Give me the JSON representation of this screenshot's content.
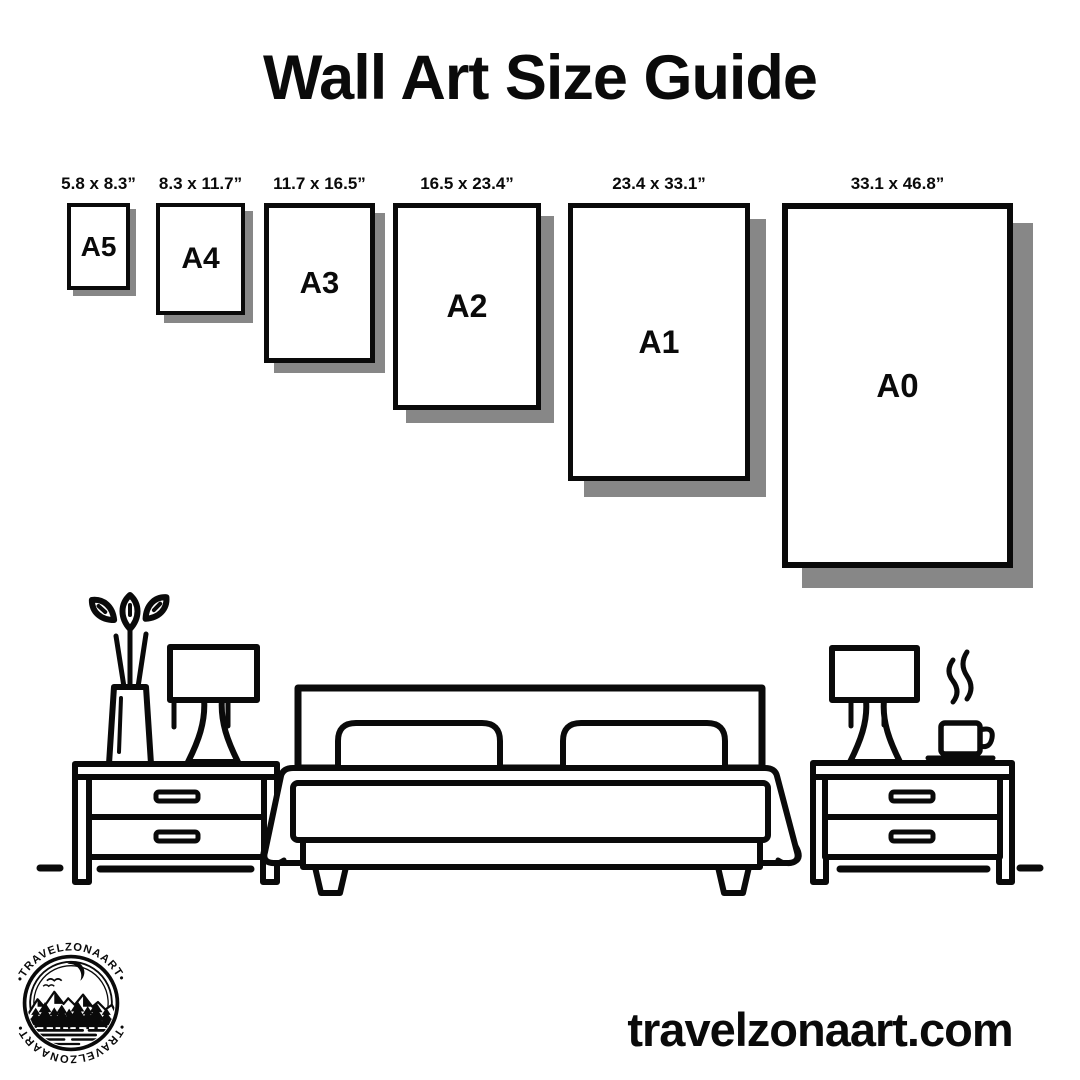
{
  "title": "Wall Art Size Guide",
  "sizes": [
    {
      "code": "A5",
      "dimensions": "5.8 x 8.3”"
    },
    {
      "code": "A4",
      "dimensions": "8.3 x 11.7”"
    },
    {
      "code": "A3",
      "dimensions": "11.7 x 16.5”"
    },
    {
      "code": "A2",
      "dimensions": "16.5 x 23.4”"
    },
    {
      "code": "A1",
      "dimensions": "23.4 x 33.1”"
    },
    {
      "code": "A0",
      "dimensions": "33.1 x 46.8”"
    }
  ],
  "illustration": {
    "icons": [
      "plant-vase-icon",
      "table-lamp-left-icon",
      "nightstand-left-icon",
      "double-bed-icon",
      "nightstand-right-icon",
      "table-lamp-right-icon",
      "coffee-cup-icon",
      "floor-line"
    ]
  },
  "logo": {
    "brand_top": "•TRAVELZONAART•",
    "brand_bottom": "•TRAVELZONAART•"
  },
  "footer": {
    "website": "travelzonaart.com"
  },
  "colors": {
    "ink": "#0a0a0a",
    "shadow": "#878787",
    "background": "#ffffff"
  }
}
